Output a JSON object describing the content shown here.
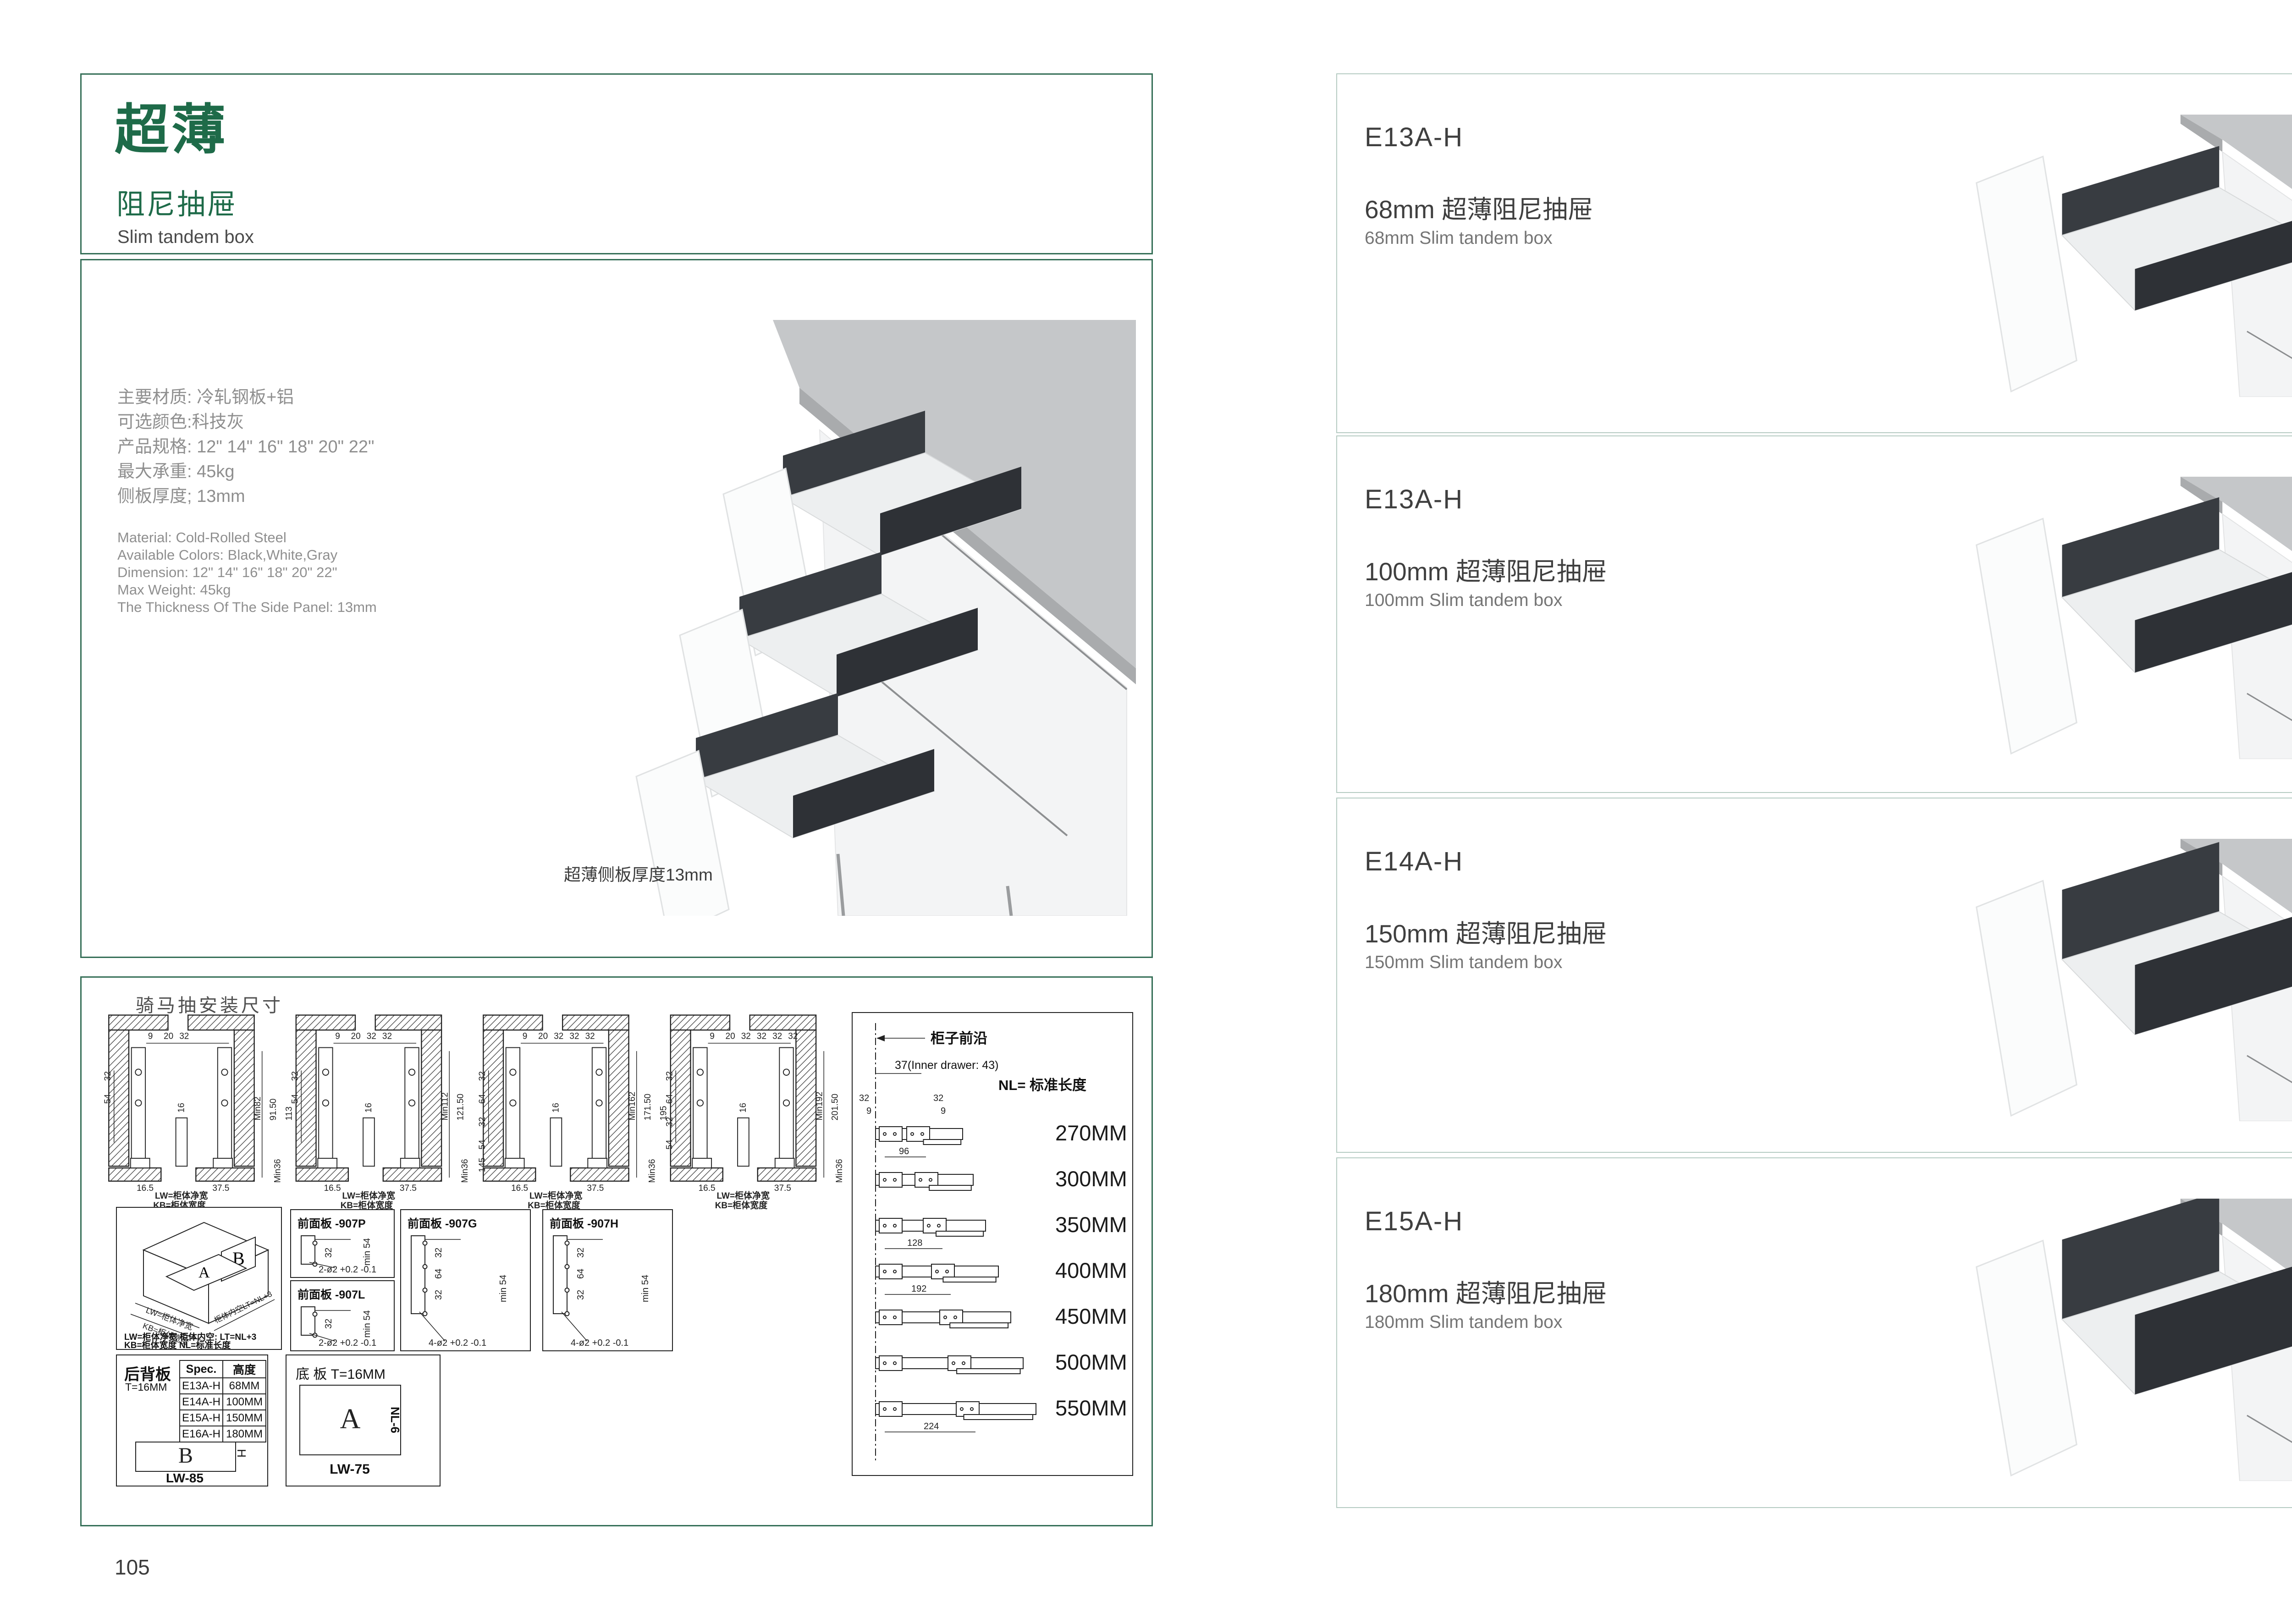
{
  "colors": {
    "green": "#1e6b49",
    "left_border": "#356f57",
    "right_border": "#b5cbc2",
    "counter": "#c5c7c9",
    "counter_edge": "#a9abad",
    "cabinet": "#f3f4f5",
    "panel_dark": "#383c41",
    "panel_dark2": "#2e3136",
    "interior": "#edeff0"
  },
  "left_page": {
    "page_number": "105",
    "header": {
      "title": "超薄",
      "subtitle": "阻尼抽屉",
      "subtitle_en": "Slim tandem box"
    },
    "specs_cn": [
      "主要材质: 冷轧钢板+铝",
      "可选颜色:科技灰",
      "产品规格: 12\" 14\" 16\" 18\" 20\" 22\"",
      "最大承重: 45kg",
      "侧板厚度; 13mm"
    ],
    "specs_en": [
      "Material: Cold-Rolled Steel",
      "Available Colors: Black,White,Gray",
      "Dimension: 12\" 14\" 16\" 18\" 20\" 22\"",
      "Max Weight: 45kg",
      "The Thickness Of The Side Panel: 13mm"
    ],
    "photo_caption": "超薄侧板厚度13mm",
    "install": {
      "title": "骑马抽安装尺寸",
      "lw_label": "LW=柜体净宽",
      "kb_label": "KB=柜体宽度",
      "cross_sections": [
        {
          "top": [
            "9",
            "20",
            "32"
          ],
          "left": [
            "32",
            "54"
          ],
          "mid": "16",
          "right": [
            "Min82",
            "91.50",
            "113"
          ],
          "bottom": [
            "16.5",
            "37.5"
          ],
          "corner": "Min36"
        },
        {
          "top": [
            "9",
            "20",
            "32",
            "32"
          ],
          "left": [
            "32",
            "54"
          ],
          "mid": "16",
          "right": [
            "Min112",
            "121.50"
          ],
          "bottom": [
            "16.5",
            "37.5"
          ],
          "corner": "Min36"
        },
        {
          "top": [
            "9",
            "20",
            "32",
            "32",
            "32"
          ],
          "left": [
            "32",
            "64",
            "32",
            "54",
            "145"
          ],
          "mid": "16",
          "right": [
            "Min162",
            "171.50",
            "195"
          ],
          "bottom": [
            "16.5",
            "37.5"
          ],
          "corner": "Min36"
        },
        {
          "top": [
            "9",
            "20",
            "32",
            "32",
            "32",
            "32"
          ],
          "left": [
            "32",
            "64",
            "32",
            "54"
          ],
          "mid": "16",
          "right": [
            "Min192",
            "201.50",
            "225"
          ],
          "bottom": [
            "16.5",
            "37.5"
          ],
          "corner": "Min36"
        }
      ],
      "iso": {
        "a": "A",
        "b": "B",
        "lw": "LW=柜体净宽",
        "kb": "KB=柜体宽度",
        "lt": "柜体内空LT=NL+3",
        "legend_row1": "LW=柜体净宽      柜体内空: LT=NL+3",
        "legend_row2": "KB=柜体宽度      NL=标准长度"
      },
      "front_panels": [
        {
          "title": "前面板",
          "code": "-907P",
          "side_dims": [
            "32"
          ],
          "min_label": "min 54",
          "holes": 2,
          "holes_note": "2-ø2 +0.2 -0.1"
        },
        {
          "title": "前面板",
          "code": "-907L",
          "side_dims": [
            "32"
          ],
          "min_label": "min 54",
          "holes": 2,
          "holes_note": "2-ø2 +0.2 -0.1"
        },
        {
          "title": "前面板",
          "code": "-907G",
          "side_dims": [
            "32",
            "64",
            "32"
          ],
          "min_label": "min 54",
          "holes": 4,
          "holes_note": "4-ø2 +0.2 -0.1"
        },
        {
          "title": "前面板",
          "code": "-907H",
          "side_dims": [
            "32",
            "64",
            "32"
          ],
          "min_label": "min 54",
          "holes": 4,
          "holes_note": "4-ø2 +0.2 -0.1"
        }
      ],
      "back_panel": {
        "name": "后背板",
        "thickness": "T=16MM",
        "table_headers": [
          "Spec.",
          "高度"
        ],
        "table_rows": [
          [
            "E13A-H",
            "68MM"
          ],
          [
            "E14A-H",
            "100MM"
          ],
          [
            "E15A-H",
            "150MM"
          ],
          [
            "E16A-H",
            "180MM"
          ]
        ],
        "letter": "B",
        "h_label": "H",
        "w_label": "LW-85"
      },
      "bottom_panel": {
        "name": "底 板 T=16MM",
        "letter": "A",
        "h_label": "NL-6",
        "w_label": "LW-75"
      },
      "nl_panel": {
        "front_edge": "柜子前沿",
        "inner_offset": "37(Inner drawer: 43)",
        "nl": "NL= 标准长度",
        "dims_small": [
          "32",
          "9",
          "32",
          "9"
        ],
        "rails": [
          {
            "length": "270MM",
            "pitch": "96"
          },
          {
            "length": "300MM",
            "pitch": ""
          },
          {
            "length": "350MM",
            "pitch": "128"
          },
          {
            "length": "400MM",
            "pitch": "192"
          },
          {
            "length": "450MM",
            "pitch": ""
          },
          {
            "length": "500MM",
            "pitch": ""
          },
          {
            "length": "550MM",
            "pitch": "224"
          }
        ]
      }
    }
  },
  "right_page": {
    "page_number": "106",
    "products": [
      {
        "code": "E13A-H",
        "name_cn": "68mm 超薄阻尼抽屉",
        "name_en": "68mm Slim tandem box",
        "panel_mm": 68
      },
      {
        "code": "E13A-H",
        "name_cn": "100mm 超薄阻尼抽屉",
        "name_en": "100mm Slim tandem box",
        "panel_mm": 100
      },
      {
        "code": "E14A-H",
        "name_cn": "150mm 超薄阻尼抽屉",
        "name_en": "150mm Slim tandem box",
        "panel_mm": 150
      },
      {
        "code": "E15A-H",
        "name_cn": "180mm 超薄阻尼抽屉",
        "name_en": "180mm Slim tandem box",
        "panel_mm": 180
      }
    ]
  }
}
